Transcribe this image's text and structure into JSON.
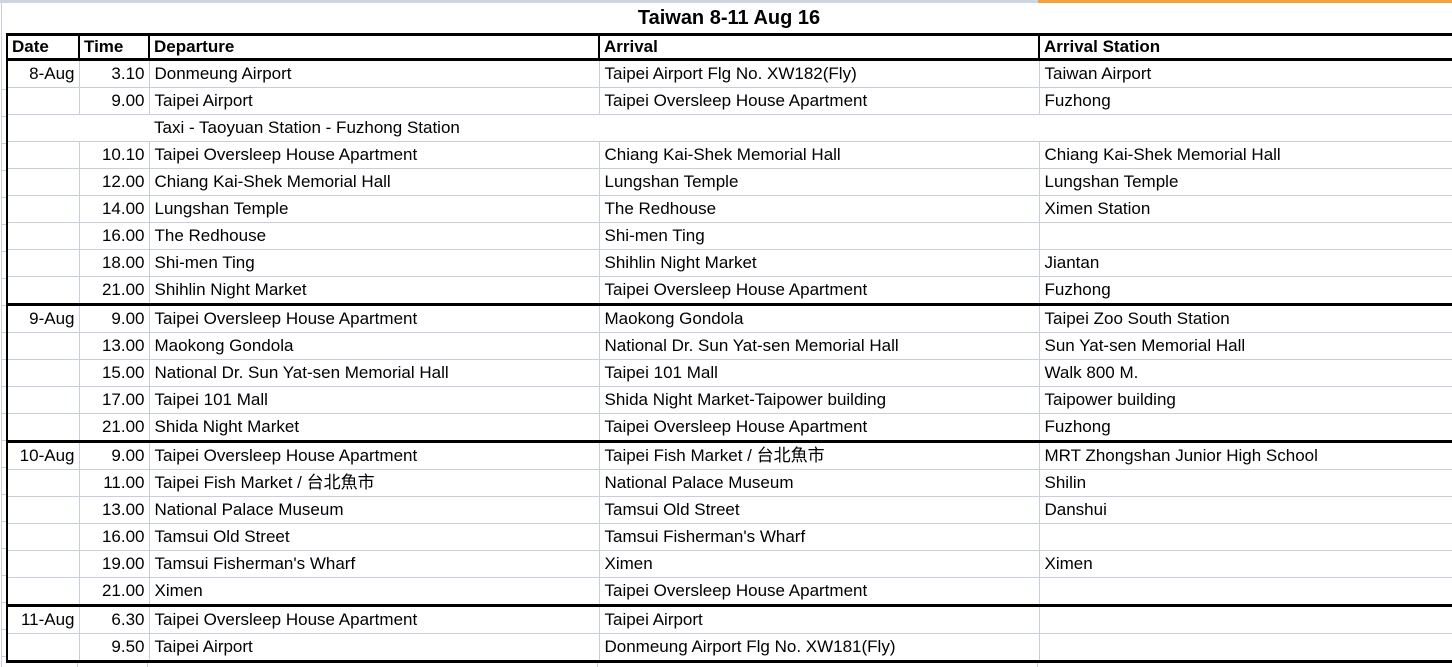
{
  "title": "Taiwan 8-11 Aug 16",
  "columns": [
    "Date",
    "Time",
    "Departure",
    "Arrival",
    "Arrival Station"
  ],
  "colors": {
    "gridline": "#c9cfda",
    "section_border": "#000000",
    "top_sliver_left": "#cdd5e4",
    "top_sliver_right_orange": "#f2a33f",
    "background": "#ffffff",
    "text": "#000000"
  },
  "sections": [
    {
      "date": "8-Aug",
      "rows": [
        {
          "cells": [
            "8-Aug",
            "3.10",
            "Donmeung Airport",
            "Taipei Airport Flg No. XW182(Fly)",
            "Taiwan Airport"
          ]
        },
        {
          "cells": [
            "",
            "9.00",
            "Taipei Airport",
            "Taipei Oversleep House Apartment",
            "Fuzhong"
          ]
        },
        {
          "cells": [
            "",
            "",
            "Taxi - Taoyuan Station - Fuzhong Station",
            "",
            ""
          ],
          "span_all": true
        },
        {
          "cells": [
            "",
            "10.10",
            "Taipei Oversleep House Apartment",
            "Chiang Kai-Shek Memorial Hall",
            "Chiang Kai-Shek Memorial Hall"
          ]
        },
        {
          "cells": [
            "",
            "12.00",
            "Chiang Kai-Shek Memorial Hall",
            "Lungshan Temple",
            "Lungshan Temple"
          ]
        },
        {
          "cells": [
            "",
            "14.00",
            "Lungshan Temple",
            "The Redhouse",
            "Ximen Station"
          ]
        },
        {
          "cells": [
            "",
            "16.00",
            "The Redhouse",
            "Shi-men Ting",
            ""
          ]
        },
        {
          "cells": [
            "",
            "18.00",
            "Shi-men Ting",
            "Shihlin Night Market",
            "Jiantan"
          ]
        },
        {
          "cells": [
            "",
            "21.00",
            "Shihlin Night Market",
            "Taipei Oversleep House Apartment",
            "Fuzhong"
          ]
        }
      ]
    },
    {
      "date": "9-Aug",
      "rows": [
        {
          "cells": [
            "9-Aug",
            "9.00",
            "Taipei Oversleep House Apartment",
            "Maokong Gondola",
            "Taipei Zoo South Station"
          ]
        },
        {
          "cells": [
            "",
            "13.00",
            "Maokong Gondola",
            "National Dr. Sun Yat-sen Memorial Hall",
            "Sun Yat-sen Memorial Hall"
          ]
        },
        {
          "cells": [
            "",
            "15.00",
            "National Dr. Sun Yat-sen Memorial Hall",
            "Taipei 101 Mall",
            "Walk 800 M."
          ]
        },
        {
          "cells": [
            "",
            "17.00",
            "Taipei 101 Mall",
            "Shida Night Market-Taipower building",
            "Taipower building"
          ]
        },
        {
          "cells": [
            "",
            "21.00",
            "Shida Night Market",
            "Taipei Oversleep House Apartment",
            "Fuzhong"
          ]
        }
      ]
    },
    {
      "date": "10-Aug",
      "rows": [
        {
          "cells": [
            "10-Aug",
            "9.00",
            "Taipei Oversleep House Apartment",
            "Taipei Fish Market / 台北魚市",
            "MRT Zhongshan Junior High School"
          ]
        },
        {
          "cells": [
            "",
            "11.00",
            "Taipei Fish Market / 台北魚市",
            "National Palace Museum",
            "Shilin"
          ]
        },
        {
          "cells": [
            "",
            "13.00",
            "National Palace Museum",
            "Tamsui Old Street",
            "Danshui"
          ]
        },
        {
          "cells": [
            "",
            "16.00",
            "Tamsui Old Street",
            "Tamsui Fisherman's Wharf",
            ""
          ]
        },
        {
          "cells": [
            "",
            "19.00",
            "Tamsui Fisherman's Wharf",
            "Ximen",
            "Ximen"
          ]
        },
        {
          "cells": [
            "",
            "21.00",
            "Ximen",
            "Taipei Oversleep House Apartment",
            ""
          ]
        }
      ]
    },
    {
      "date": "11-Aug",
      "rows": [
        {
          "cells": [
            "11-Aug",
            "6.30",
            "Taipei Oversleep House Apartment",
            "Taipei Airport",
            ""
          ]
        },
        {
          "cells": [
            "",
            "9.50",
            "Taipei Airport",
            "Donmeung Airport Flg No. XW181(Fly)",
            ""
          ]
        }
      ]
    }
  ]
}
